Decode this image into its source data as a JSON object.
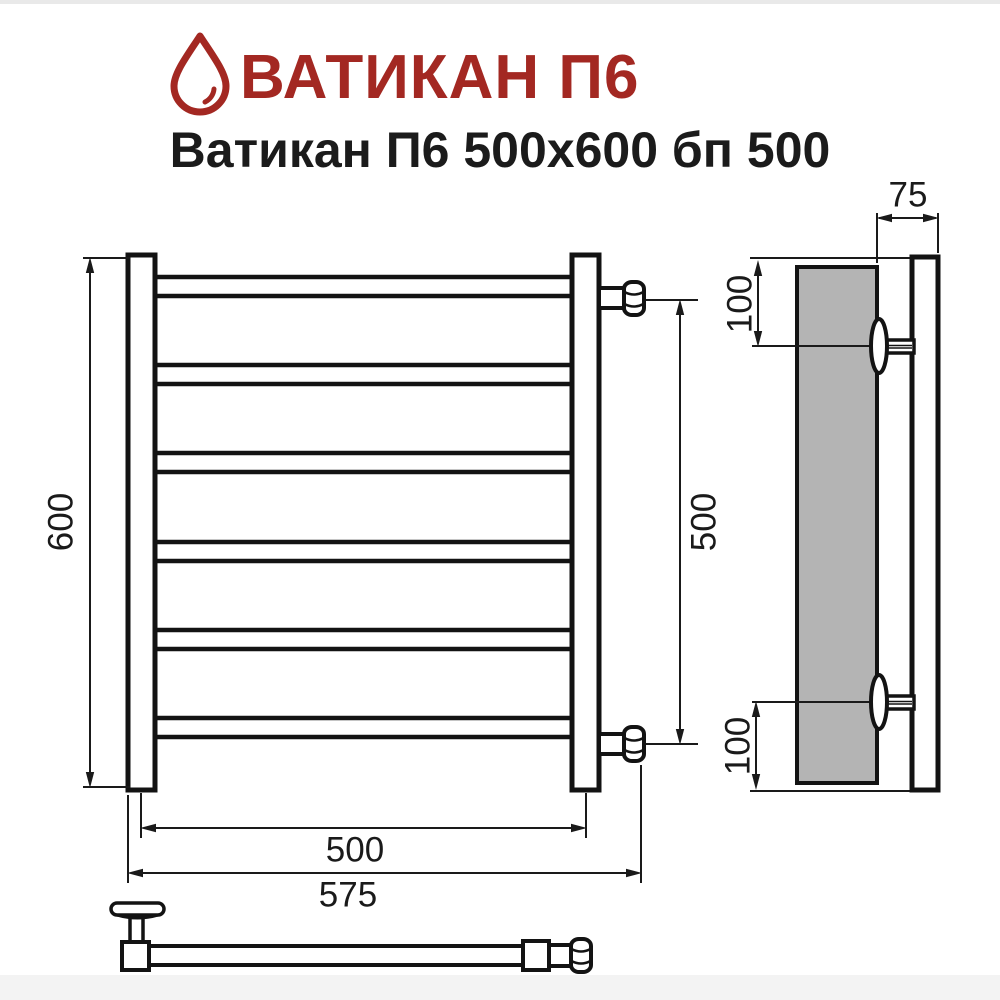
{
  "header": {
    "brand": "ВАТИКАН П6",
    "subtitle": "Ватикан П6 500x600 бп 500"
  },
  "colors": {
    "brand_red": "#a32822",
    "line_black": "#131313",
    "wall_gray": "#b4b4b4",
    "dim_text": "#1a1a1a"
  },
  "front": {
    "bars_count": 6,
    "dim_height": "600",
    "dim_connector_spacing": "500",
    "dim_axle_spacing": "500",
    "dim_overall_width": "575"
  },
  "side": {
    "dim_depth": "75",
    "dim_top_offset": "100",
    "dim_bottom_offset": "100"
  }
}
